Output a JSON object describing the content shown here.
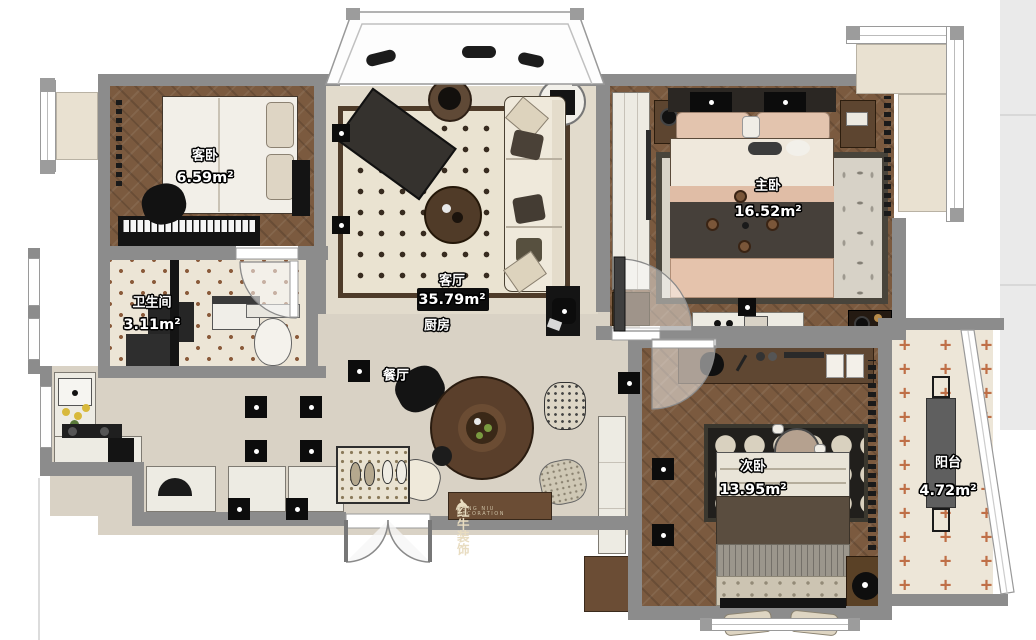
{
  "title": "apartment-floor-plan",
  "rooms": {
    "guest_bedroom": {
      "label": "客卧",
      "area": "6.59m²"
    },
    "living_room": {
      "label": "客厅",
      "area": "35.79m²"
    },
    "kitchen": {
      "label": "厨房",
      "area": ""
    },
    "dining_room": {
      "label": "餐厅",
      "area": ""
    },
    "bathroom": {
      "label": "卫生间",
      "area": "3.11m²"
    },
    "master_bedroom": {
      "label": "主卧",
      "area": "16.52m²"
    },
    "second_bedroom": {
      "label": "次卧",
      "area": "13.95m²"
    },
    "balcony": {
      "label": "阳台",
      "area": "4.72m²"
    }
  },
  "watermark": {
    "brand": "红牛装饰",
    "subtitle": "HONG NIU DECORATION"
  },
  "palette": {
    "wall": "#8c8c8c",
    "wood_floor": "#7b5a3f",
    "open_floor": "#d9d2c5",
    "tile_floor": "#ece5d6",
    "balcony_accent": "#bf6f47",
    "rug_cream": "#eae3d1",
    "furniture_dark": "#141414",
    "cabinet_white": "#edebe3",
    "cabinet_wood": "#6b4d35"
  }
}
